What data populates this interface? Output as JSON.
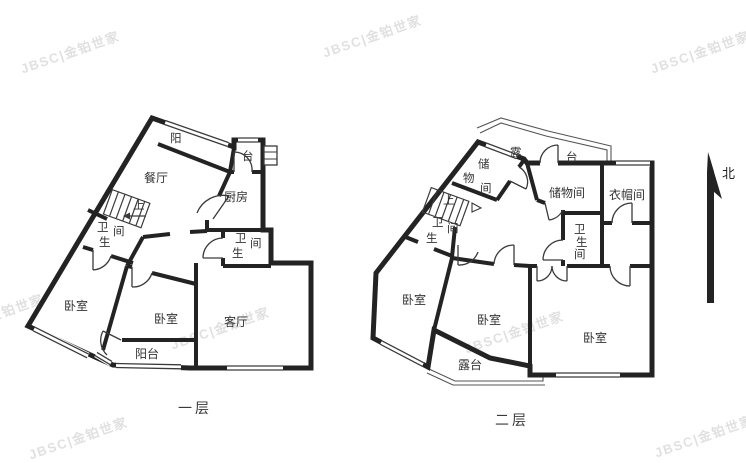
{
  "floorplan": {
    "watermark": "JBSC|金铂世家",
    "compass_north": "北",
    "floor1": {
      "label": "一层",
      "rooms": {
        "balcony_north_char1": "阳",
        "balcony_north_char2": "台",
        "dining": "餐厅",
        "kitchen": "厨房",
        "stairs_up": "上",
        "bath_west": {
          "c1": "卫",
          "c2": "生",
          "c3": "间"
        },
        "bath_east": {
          "c1": "卫",
          "c2": "生",
          "c3": "间"
        },
        "bedroom_west": "卧室",
        "bedroom_mid": "卧室",
        "living": "客厅",
        "balcony_south": "阳台"
      }
    },
    "floor2": {
      "label": "二层",
      "rooms": {
        "terrace_north_char1": "露",
        "terrace_north_char2": "台",
        "storage_small": {
          "c1": "储",
          "c2": "物",
          "c3": "间"
        },
        "storage_big": "储物间",
        "closet": "衣帽间",
        "stairs_up": "上",
        "bath_west": {
          "c1": "卫",
          "c2": "生",
          "c3": "间"
        },
        "bath_mid": {
          "c1": "卫",
          "c2": "生",
          "c3": "间"
        },
        "bedroom_west": "卧室",
        "bedroom_mid": "卧室",
        "bedroom_east": "卧室",
        "terrace_south": "露台"
      }
    }
  }
}
